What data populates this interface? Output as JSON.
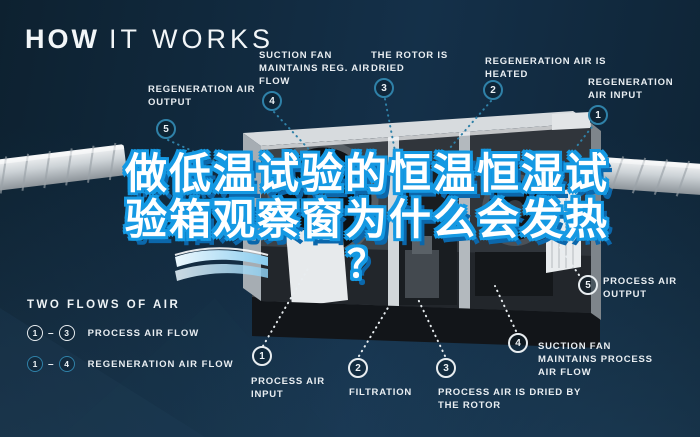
{
  "title": {
    "strong": "HOW",
    "light": "IT WORKS"
  },
  "headline": {
    "line1": "做低温试验的恒温恒湿试",
    "line2": "验箱观察窗为什么会发热",
    "line3": "？"
  },
  "steps_regen": [
    {
      "num": "5",
      "label": "REGENERATION AIR OUTPUT"
    },
    {
      "num": "4",
      "label": "SUCTION FAN MAINTAINS REG. AIR FLOW"
    },
    {
      "num": "3",
      "label": "THE ROTOR IS DRIED"
    },
    {
      "num": "2",
      "label": "REGENERATION AIR IS HEATED"
    },
    {
      "num": "1",
      "label": "REGENERATION AIR INPUT"
    }
  ],
  "steps_process": [
    {
      "num": "1",
      "label": "PROCESS AIR INPUT"
    },
    {
      "num": "2",
      "label": "FILTRATION"
    },
    {
      "num": "3",
      "label": "PROCESS AIR IS DRIED BY THE ROTOR"
    },
    {
      "num": "4",
      "label": "SUCTION FAN MAINTAINS PROCESS AIR FLOW"
    },
    {
      "num": "5",
      "label": "PROCESS AIR OUTPUT"
    }
  ],
  "legend": {
    "title": "TWO FLOWS OF AIR",
    "separator": "–",
    "rows": [
      {
        "start": "1",
        "end": "3",
        "label": "PROCESS AIR FLOW"
      },
      {
        "start": "1",
        "end": "4",
        "label": "REGENERATION AIR FLOW"
      }
    ]
  },
  "colors": {
    "accent_teal": "#2f81a8",
    "text_white": "#e9eef2",
    "headline_outline_blue": "#1599e3",
    "headline_shadow_blue": "#0b67ab",
    "background_navy": "#0e2334"
  }
}
